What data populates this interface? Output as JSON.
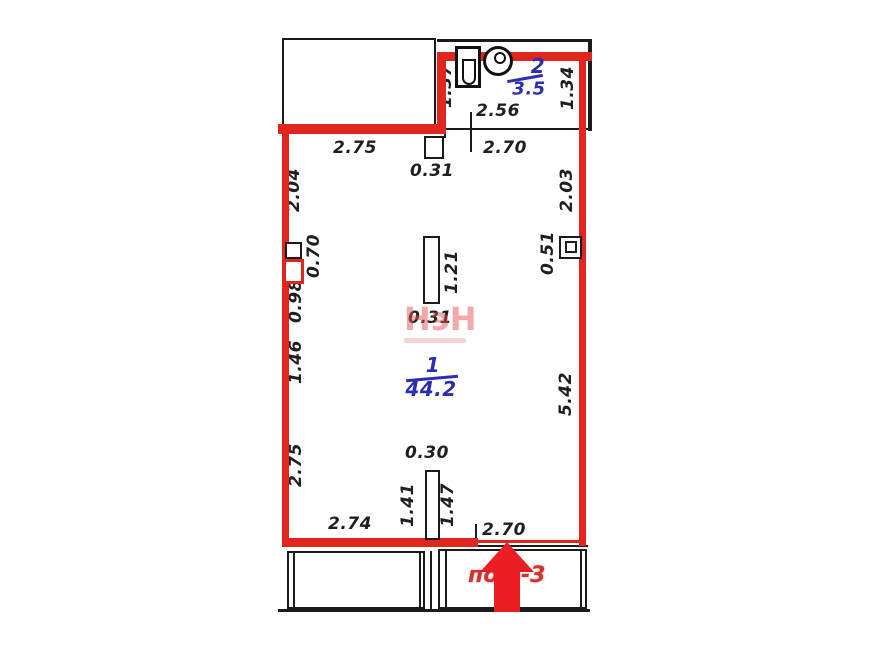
{
  "plan_title": "apartment-floor-plan",
  "rooms": {
    "bathroom": {
      "number": "2",
      "area": "3.5"
    },
    "living": {
      "number": "1",
      "area": "44.2"
    }
  },
  "dims": {
    "top_left": "2.75",
    "top_column": "0.31",
    "top_right": "2.70",
    "bath_width": "2.56",
    "bath_height_left": "1.37",
    "bath_height_right": "1.34",
    "left_upper": "2.04",
    "right_upper": "2.03",
    "left_duct": "0.70",
    "left_below_duct": "0.98",
    "left_middle": "1.46",
    "left_lower": "2.75",
    "right_duct": "0.51",
    "right_lower": "5.42",
    "column_height": "1.21",
    "column_width_mid": "0.31",
    "stub_width": "0.30",
    "stub_height_left": "1.41",
    "stub_height_right": "1.47",
    "bottom_left": "2.74",
    "bottom_right": "2.70"
  },
  "annotations": {
    "watermark": "НэН",
    "premise_label_left": "по",
    "premise_label_right": "-3"
  },
  "colors": {
    "boundary_red": "#e1251f",
    "arrow_red": "#ec1e24",
    "label_blue": "#2d2db4",
    "premise_red": "#cf3434",
    "walls_black": "#1b1b1b"
  }
}
